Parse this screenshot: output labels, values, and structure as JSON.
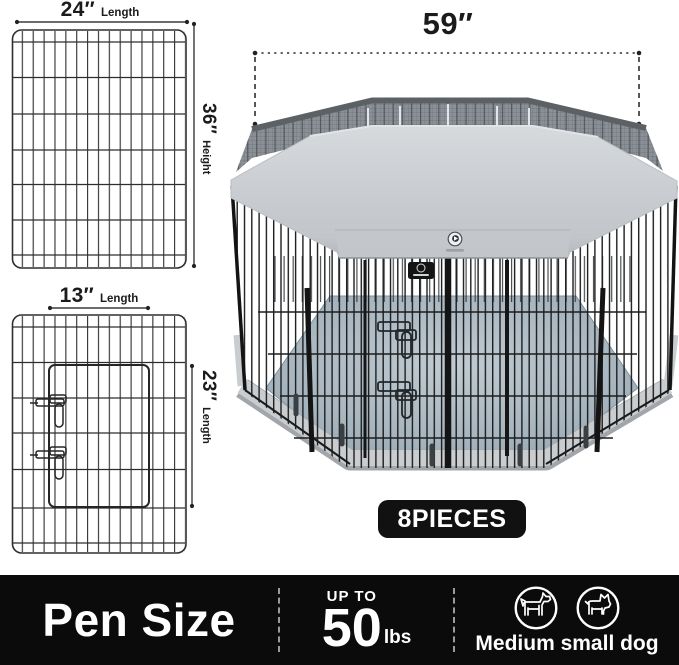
{
  "diagram": {
    "panel_full": {
      "width": "24″",
      "width_unit": "Length",
      "height": "36″",
      "height_unit": "Height"
    },
    "panel_door": {
      "width": "13″",
      "width_unit": "Length",
      "height": "23″",
      "height_unit": "Length"
    },
    "pen_width": "59″",
    "pieces_badge": "8PIECES"
  },
  "info_bar": {
    "title": "Pen Size",
    "weight_prefix": "UP TO",
    "weight_value": "50",
    "weight_unit": "lbs",
    "dog_label": "Medium small dog"
  },
  "icons": {
    "medium_dog": "medium-dog-icon",
    "small_dog": "small-dog-icon",
    "brand_logo": "brand-logo-icon"
  },
  "colors": {
    "bar_bg": "#0b0b0b",
    "badge_bg": "#111111",
    "text_light": "#ffffff",
    "text_dark": "#1b1b1b",
    "cover_gray": "#c9cdd1",
    "mesh_gray": "#8a9096",
    "floor_blue_gray": "#a9b7c1",
    "base_gray": "#c9cdd0",
    "wire_black": "#1d1d1d"
  }
}
